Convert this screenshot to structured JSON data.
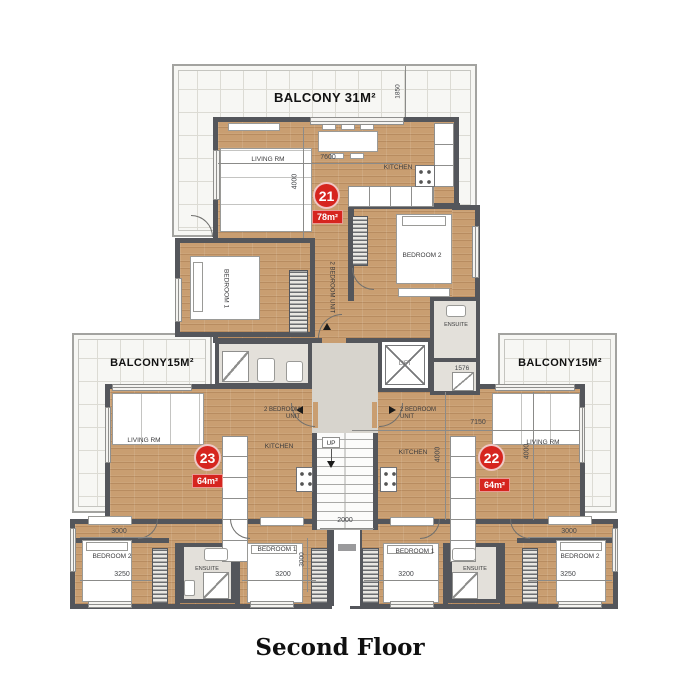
{
  "title": "Second Floor",
  "labels": {
    "balcony_top": "BALCONY 31M²",
    "balcony_side": "BALCONY15M²",
    "living": "LIVING RM",
    "kitchen": "KITCHEN",
    "bedroom1": "BEDROOM 1",
    "bedroom2": "BEDROOM 2",
    "ensuite": "ENSUITE",
    "lift": "LIFT",
    "up": "UP",
    "unit_line1": "2 BEDROOM",
    "unit_line2": "UNIT",
    "unit_vertical": "2 BEDROOM UNIT"
  },
  "units": {
    "u21": {
      "number": "21",
      "area": "78m²"
    },
    "u22": {
      "number": "22",
      "area": "64m²"
    },
    "u23": {
      "number": "23",
      "area": "64m²"
    }
  },
  "dims": {
    "d7600": "7600",
    "d4000": "4000",
    "d1850": "1850",
    "d7150": "7150",
    "d1576": "1576",
    "d2000": "2000",
    "d3000": "3000",
    "d3200": "3200",
    "d3250": "3250"
  },
  "colors": {
    "accent_red": "#d6251f",
    "wall": "#54565b",
    "wood_floor": "#c99e71",
    "balcony_tile": "#f7f7f4"
  }
}
